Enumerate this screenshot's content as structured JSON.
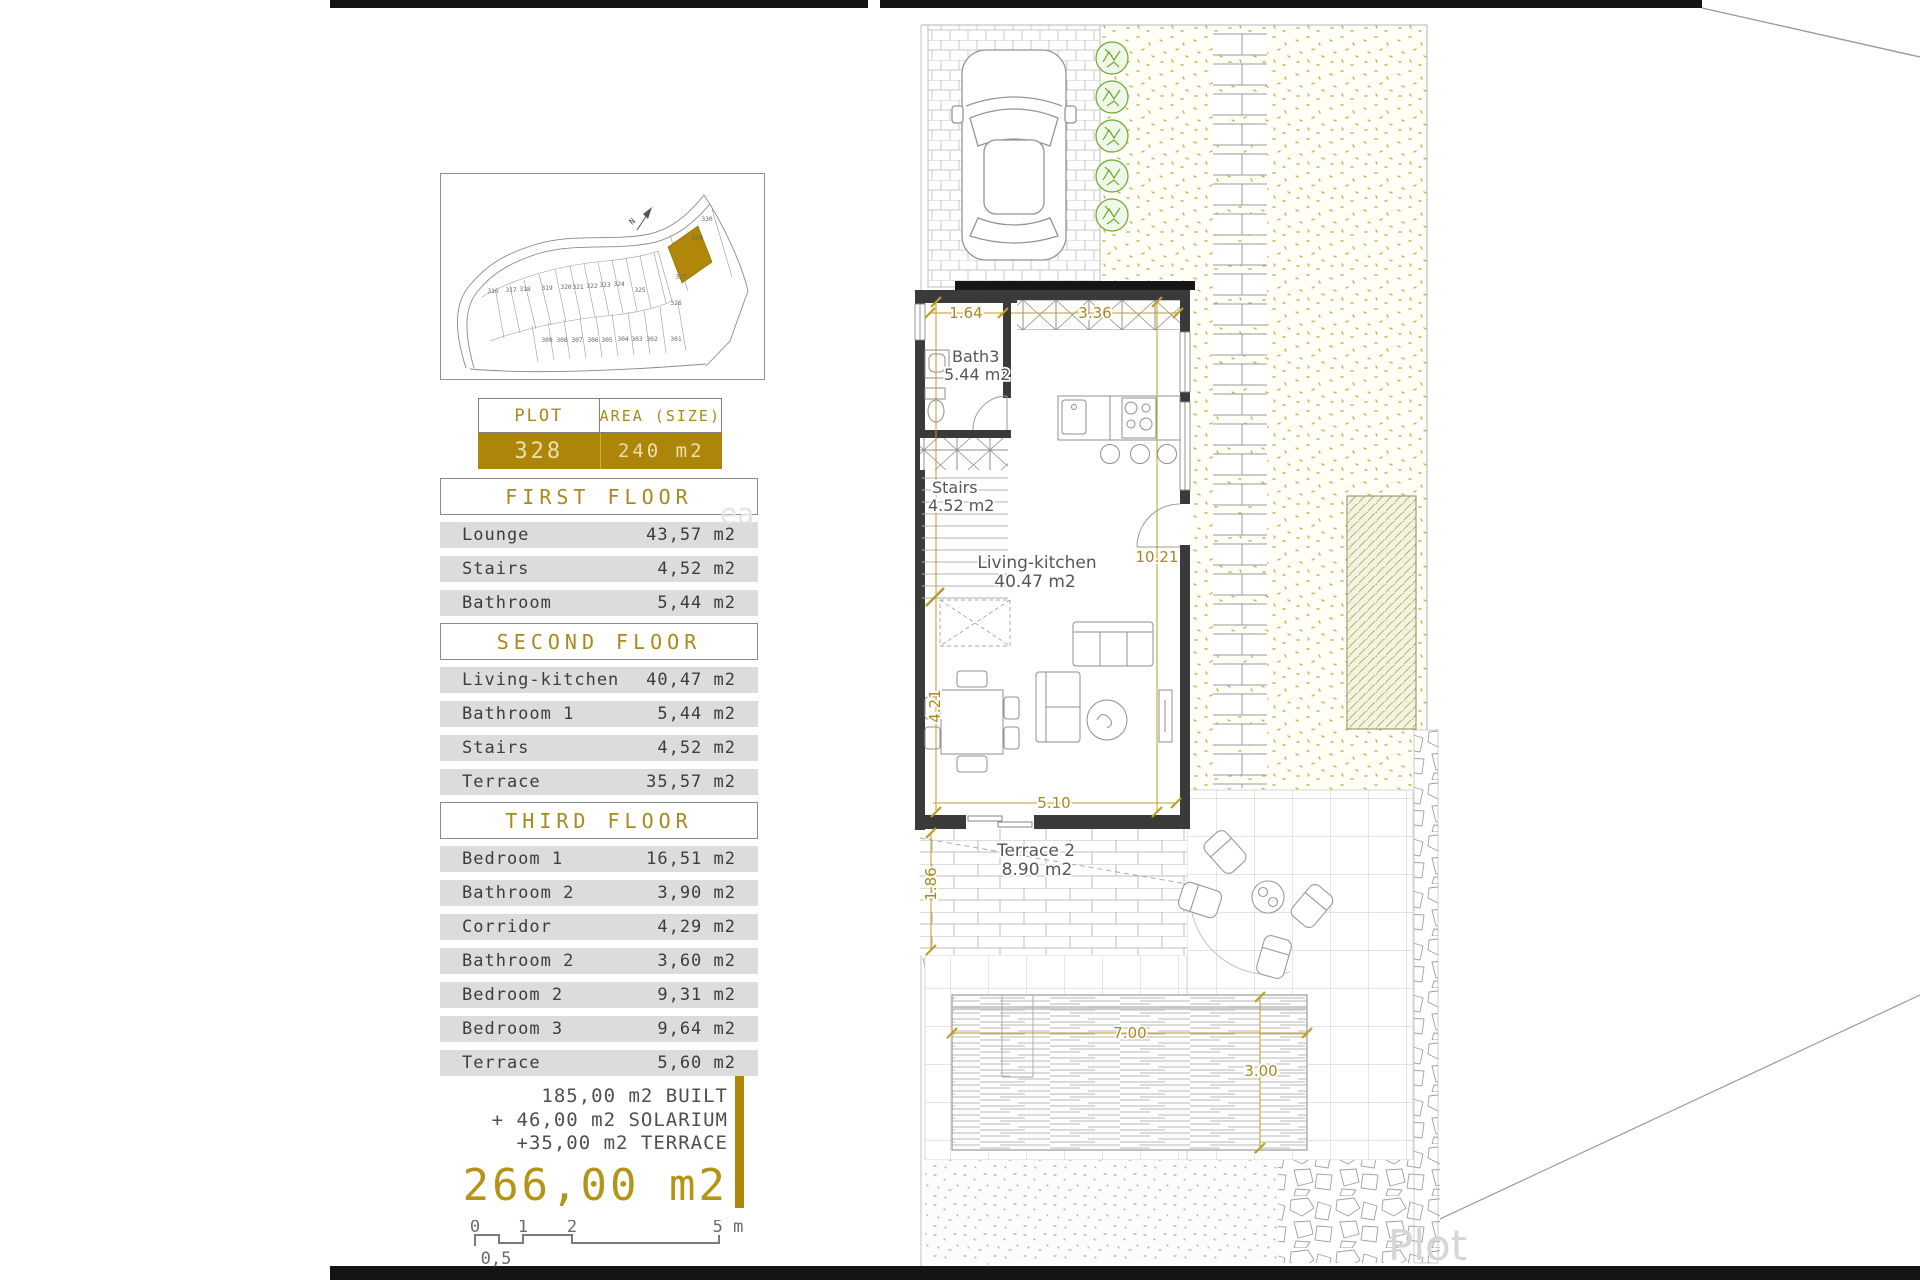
{
  "location_diagram": {
    "north_label": "N",
    "plots_top": [
      "316",
      "317",
      "318",
      "319",
      "320",
      "321",
      "322",
      "323",
      "324",
      "325"
    ],
    "plot_326": "326",
    "plots_right": [
      "330",
      "329",
      "327"
    ],
    "plots_bottom": [
      "309",
      "308",
      "307",
      "306",
      "305",
      "304",
      "303",
      "302",
      "301"
    ],
    "highlighted_plot": "328",
    "highlighted_plot_color": "#b08708"
  },
  "plot_table": {
    "headers": [
      "PLOT",
      "AREA (SIZE)"
    ],
    "plot_number": "328",
    "area": "240 m2"
  },
  "floors": [
    {
      "title": "FIRST FLOOR",
      "rows": [
        [
          "Lounge",
          "43,57 m2"
        ],
        [
          "Stairs",
          "4,52 m2"
        ],
        [
          "Bathroom",
          "5,44 m2"
        ]
      ]
    },
    {
      "title": "SECOND FLOOR",
      "rows": [
        [
          "Living-kitchen",
          "40,47 m2"
        ],
        [
          "Bathroom 1",
          "5,44 m2"
        ],
        [
          "Stairs",
          "4,52 m2"
        ],
        [
          "Terrace",
          "35,57 m2"
        ]
      ]
    },
    {
      "title": "THIRD FLOOR",
      "rows": [
        [
          "Bedroom 1",
          "16,51 m2"
        ],
        [
          "Bathroom 2",
          "3,90 m2"
        ],
        [
          "Corridor",
          "4,29 m2"
        ],
        [
          "Bathroom 2",
          "3,60 m2"
        ],
        [
          "Bedroom 2",
          "9,31 m2"
        ],
        [
          "Bedroom 3",
          "9,64 m2"
        ],
        [
          "Terrace",
          "5,60 m2"
        ]
      ]
    }
  ],
  "totals": {
    "lines": [
      "185,00 m2 BUILT",
      "+ 46,00 m2 SOLARIUM",
      "+35,00 m2 TERRACE"
    ],
    "total": "266,00 m2"
  },
  "scale_bar": {
    "tick_0": "0",
    "tick_half": "0,5",
    "tick_1": "1",
    "tick_2": "2",
    "tick_end": "5 m"
  },
  "plan": {
    "labels": {
      "bath": "Bath3",
      "bath_area": "5.44 m2",
      "stairs": "Stairs",
      "stairs_area": "4.52 m2",
      "living": "Living-kitchen",
      "living_area": "40.47 m2",
      "terrace": "Terrace 2",
      "terrace_area": "8.90 m2"
    },
    "dims": {
      "entry_left": "1.64",
      "entry_right": "3.36",
      "interior_height": "10.21",
      "interior_left": "4.21",
      "living_width": "5.10",
      "terrace_depth": "1.86",
      "pool_width": "7.00",
      "pool_depth": "3.00"
    }
  },
  "watermarks": {
    "plot": "Plot",
    "fragment": "ea"
  },
  "colors": {
    "accent_gold": "#ad8609",
    "dim_gold": "#a8891c",
    "row_gray": "#dcdcdc",
    "wall_dark": "#3a3a3a",
    "tree_green": "#69aa2e",
    "hatch_olive": "#a7a763"
  }
}
